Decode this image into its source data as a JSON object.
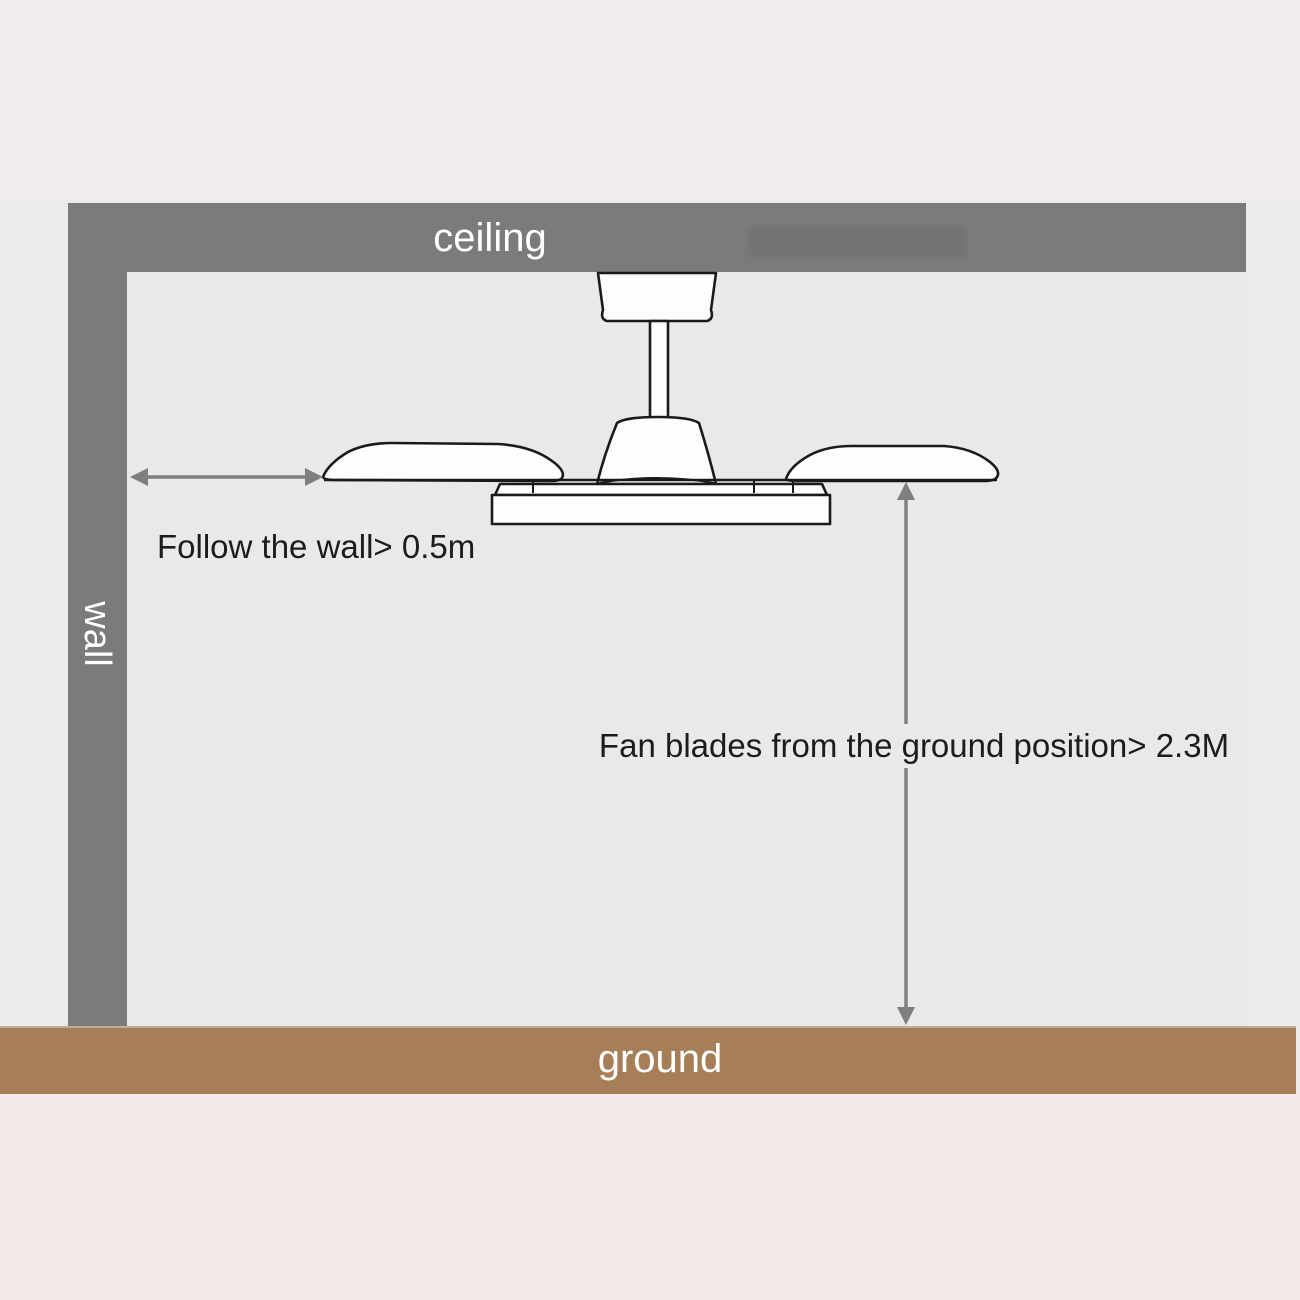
{
  "room": {
    "ceiling_label": "ceiling",
    "wall_label": "wall",
    "ground_label": "ground"
  },
  "annotations": {
    "wall_clearance": "Follow the wall> 0.5m",
    "ground_clearance": "Fan blades from the ground position> 2.3M"
  },
  "illustration": {
    "subject": "ceiling fan side view with canopy, downrod, motor housing, two blades and bottom light plate"
  },
  "measurements": {
    "wall_to_blade_min": "0.5m",
    "blade_to_ground_min": "2.3M"
  },
  "colors": {
    "structure_gray": "#7b7b7b",
    "ground_brown": "#a67f58",
    "arrow_gray": "#7f7f7f",
    "annotation_text": "#1c1c1c",
    "outer_background_top": "#f1ecec",
    "outer_background_bottom": "#f2eae8",
    "room_background": "#e9e9e9",
    "fan_fill": "#fdfdfd",
    "fan_outline": "#1a1a1a"
  }
}
